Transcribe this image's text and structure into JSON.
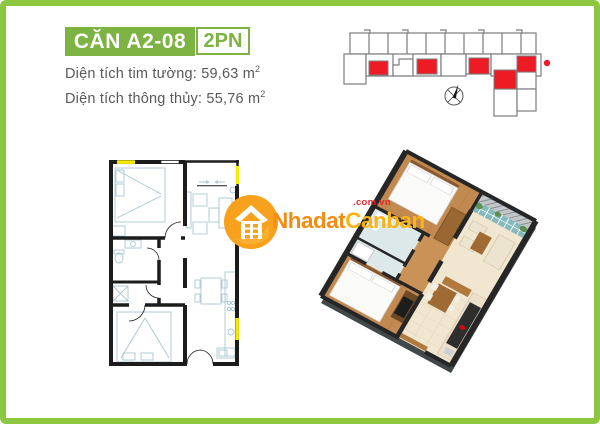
{
  "header": {
    "unit_code": "CĂN A2-08",
    "unit_type": "2PN"
  },
  "areas": {
    "wall": {
      "label": "Diện tích tim tường:",
      "value": " 59,63 m",
      "sup": "2"
    },
    "clear": {
      "label": "Diện tích thông thủy:",
      "value": " 55,76 m",
      "sup": "2"
    }
  },
  "watermark": {
    "brand_primary": "Nhadat",
    "brand_secondary": "Canban",
    "domain_suffix": ".com.vn"
  },
  "colors": {
    "frame_green": "#8dc63f",
    "header_green": "#7cb342",
    "highlight_red": "#ed1c24",
    "window_yellow": "#f8ec00",
    "brand_orange": "#f7a11c",
    "text_gray": "#58595b",
    "wall_black": "#1c1c1c"
  },
  "icons": {
    "compass": "compass-icon",
    "house": "house-logo-icon",
    "unit_marker": "current-unit-dot"
  }
}
